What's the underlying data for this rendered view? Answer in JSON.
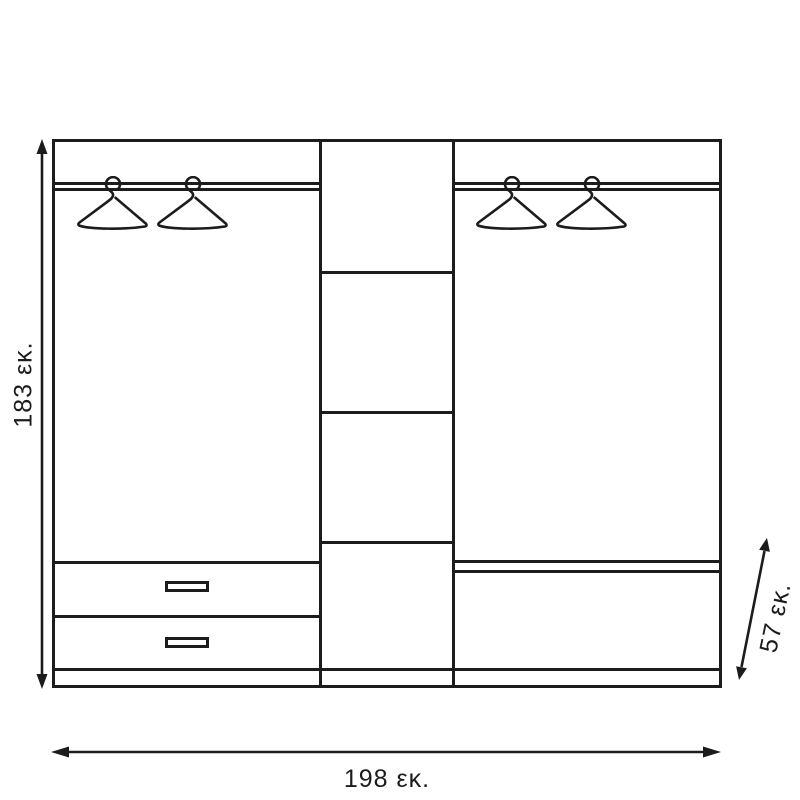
{
  "diagram": {
    "kind": "wardrobe front-view technical drawing",
    "labels": {
      "height": "183 εκ.",
      "width": "198 εκ.",
      "depth": "57 εκ."
    },
    "colors": {
      "line": "#1c1c1c",
      "background": "#ffffff"
    },
    "sections": {
      "left": {
        "hanging_rod": true,
        "hangers": 2,
        "drawers": 2
      },
      "middle": {
        "shelves": 3,
        "compartments": 4
      },
      "right": {
        "hanging_rod": true,
        "hangers": 2,
        "shelves": 1
      }
    }
  }
}
